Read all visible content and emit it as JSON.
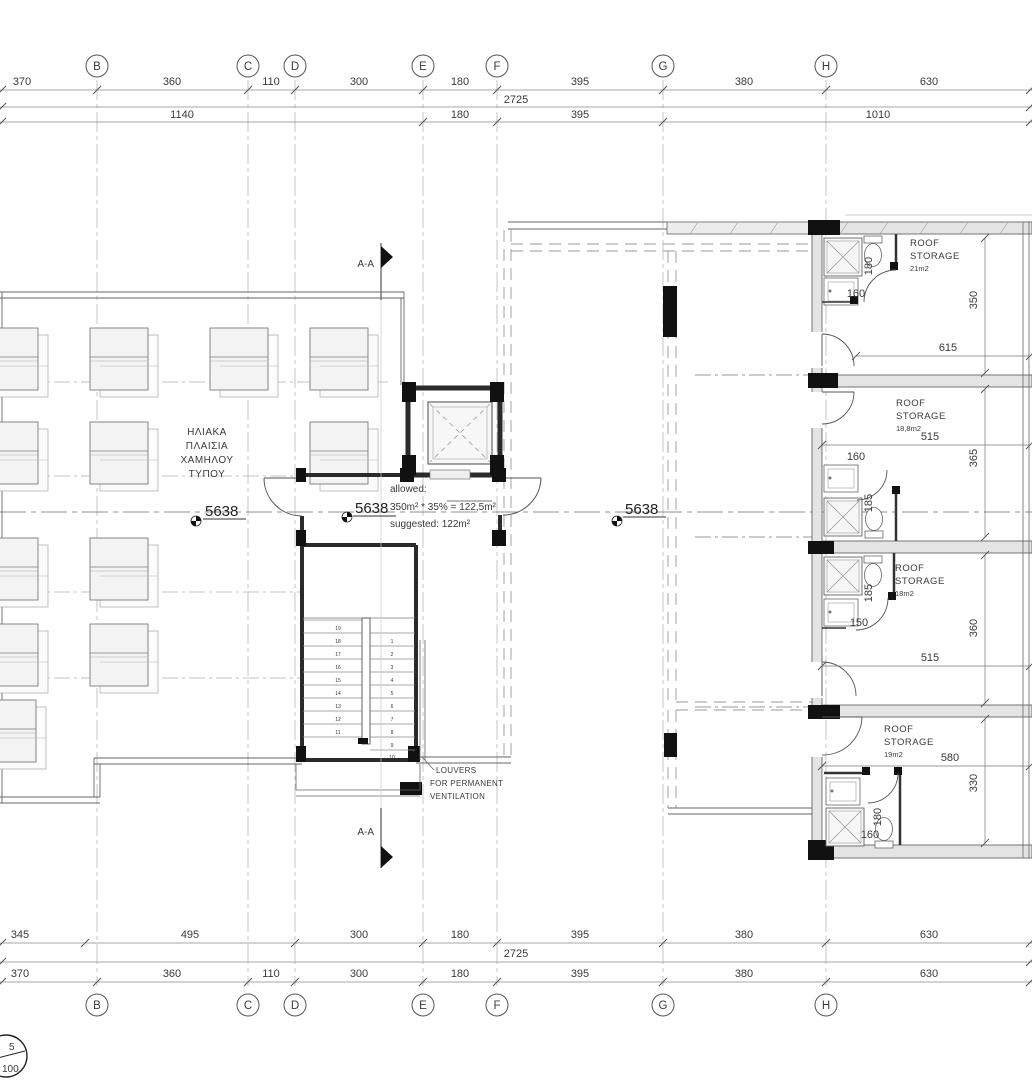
{
  "drawing": {
    "grid": {
      "letters": [
        "B",
        "C",
        "D",
        "E",
        "F",
        "G",
        "H"
      ]
    },
    "dims": {
      "top1": [
        "370",
        "360",
        "110",
        "300",
        "180",
        "395",
        "380",
        "630"
      ],
      "top_total": "2725",
      "top2": [
        "1140",
        "180",
        "395",
        "1010"
      ],
      "bottom1": [
        "345",
        "495",
        "300",
        "180",
        "395",
        "380",
        "630"
      ],
      "bottom_total": "2725",
      "bottom2": [
        "370",
        "360",
        "110",
        "300",
        "180",
        "395",
        "380",
        "630"
      ]
    },
    "labels": {
      "section": "A-A",
      "level": "5638",
      "solar": [
        "ΗΛΙΑΚΑ",
        "ΠΛΑΙΣΙΑ",
        "ΧΑΜΗΛΟΥ",
        "ΤΥΠΟΥ"
      ],
      "area_note": [
        "allowed:",
        "350m² * 35% = 122,5m²",
        "suggested: 122m²"
      ],
      "louvers": [
        "LOUVERS",
        "FOR PERMANENT",
        "VENTILATION"
      ],
      "scale": {
        "numerator": "5",
        "denominator": "100"
      }
    },
    "rooms": [
      {
        "name1": "ROOF",
        "name2": "STORAGE",
        "area": "21m2",
        "width": "615",
        "height": "350",
        "bath_d": "180",
        "bath_w": "160"
      },
      {
        "name1": "ROOF",
        "name2": "STORAGE",
        "area": "18,8m2",
        "width": "515",
        "height": "365",
        "bath_d": "185",
        "bath_w": "160"
      },
      {
        "name1": "ROOF",
        "name2": "STORAGE",
        "area": "18m2",
        "width": "515",
        "height": "360",
        "bath_d": "185",
        "bath_w": "150"
      },
      {
        "name1": "ROOF",
        "name2": "STORAGE",
        "area": "19m2",
        "width": "580",
        "height": "330",
        "bath_d": "180",
        "bath_w": "160"
      }
    ],
    "stairs": {
      "left": [
        "19",
        "18",
        "17",
        "16",
        "15",
        "14",
        "13",
        "12",
        "11"
      ],
      "right": [
        "1",
        "2",
        "3",
        "4",
        "5",
        "6",
        "7",
        "8",
        "9",
        "10"
      ]
    }
  }
}
